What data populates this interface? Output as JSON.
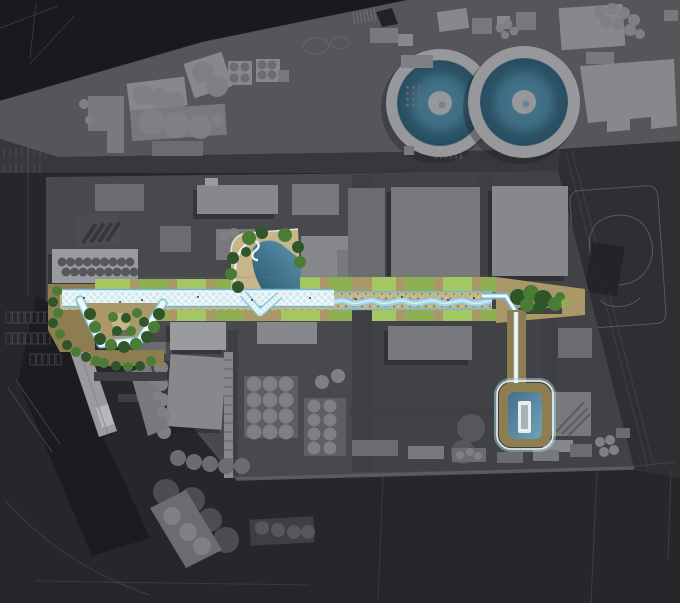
{
  "meta": {
    "label": "Aerial masterplan render: industrial district with green linear-park corridor, trellis canopy path, central pond, pocket garden, water-treatment tanks and southern pool loop",
    "type": "architectural-site-plan-render"
  },
  "palette": {
    "bg_darkest": "#191a1d",
    "bg_dark": "#26272a",
    "bg_mid": "#2e2f33",
    "land_top": "#54565a",
    "land_main": "#47494c",
    "land_main_east": "#3f4144",
    "road_dark": "#36383b",
    "road_mid": "#3d3f42",
    "edge_light": "#5d5f63",
    "faint_line": "#595b5f",
    "outline_light": "#74767b",
    "building_light": "#999b9e",
    "building_mid_light": "#86888b",
    "building_mid": "#77797c",
    "building_mid_dark": "#6a6c6f",
    "building_dark": "#5d5f62",
    "building_darker": "#4b4d50",
    "circle_gray": "#7e8083",
    "circle_gray_dark": "#55575a",
    "tank_ring": "#96989b",
    "tank_water": "#3e6c82",
    "tank_water_deep": "#27495c",
    "lawn_green": "#a3c763",
    "lawn_green_dark": "#8db052",
    "tree_green": "#4a7c36",
    "tree_green_dark": "#2e5628",
    "sand_light": "#c7b68a",
    "sand_mid": "#ab9868",
    "sand_dark": "#8f7d52",
    "pebble_dot": "#8a7950",
    "stream_blue": "#a4d8e8",
    "stream_deep": "#6fb9d2",
    "lattice_blue": "#cde9f2",
    "lattice_white": "#f4f7f8",
    "path_white": "#ecf1f3",
    "pond_deep": "#2c5a74",
    "pond_light": "#5e94ad",
    "pool_blue": "#4f82a0",
    "deck_white": "#e8edef",
    "shadow": "#1c1d20"
  },
  "features": {
    "tanks": {
      "label": "circular-clarifier-tanks",
      "count": 2
    },
    "linear_park": {
      "label": "green-linear-park-corridor"
    },
    "trellis": {
      "label": "white-lattice-canopy-path"
    },
    "stream": {
      "label": "meandering-stream-channel"
    },
    "pond": {
      "label": "central-pond-with-sand-beach"
    },
    "garden": {
      "label": "triangular-pocket-garden"
    },
    "pool_loop": {
      "label": "south-path-loop-with-plunge-pool"
    },
    "rail_platform": {
      "label": "diagonal-rail-platform"
    },
    "parking": {
      "label": "surface-parking-rows"
    },
    "industry": {
      "label": "industrial-buildings-with-silos"
    }
  }
}
